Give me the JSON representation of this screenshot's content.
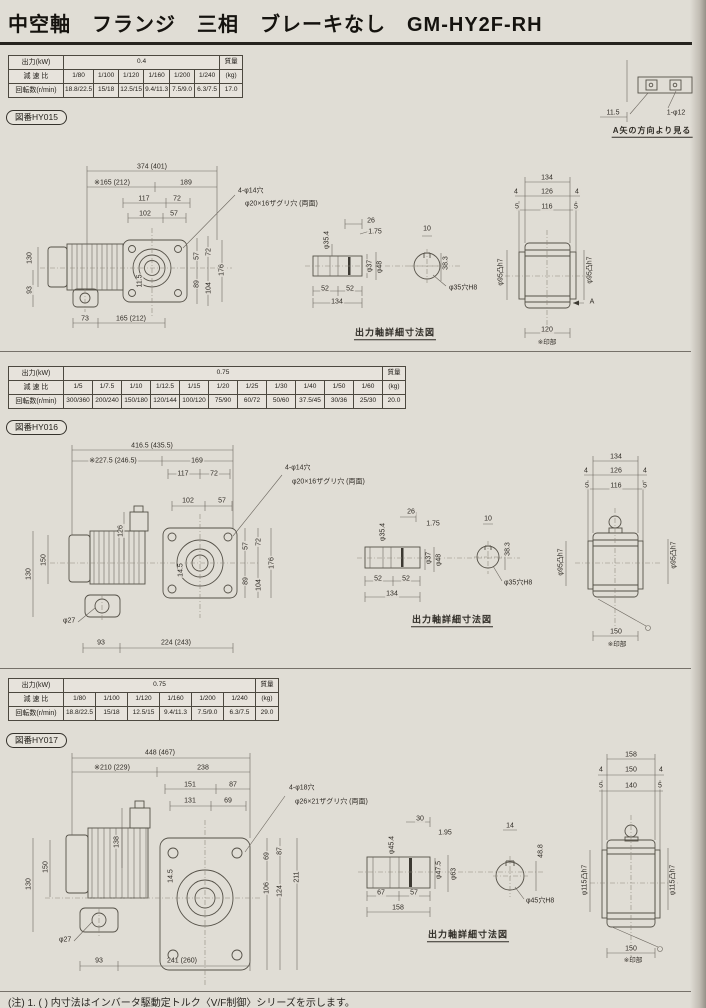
{
  "page": {
    "title": "中空軸　フランジ　三相　ブレーキなし　GM-HY2F-RH",
    "footnote": "(注) 1. ( ) 内寸法はインバータ駆動定トルク〈V/F制御〉シリーズを示します。"
  },
  "viewA": {
    "labels": [
      {
        "t": "11.5",
        "x": 613,
        "y": 113
      },
      {
        "t": "1-φ12",
        "x": 676,
        "y": 113
      },
      {
        "t": "A矢の方向より見る",
        "x": 652,
        "y": 132,
        "u": 1,
        "fs": 8
      }
    ]
  },
  "sections": [
    {
      "badge": "図番HY015",
      "table": {
        "rows": [
          {
            "head": "出力(kW)",
            "merged": "0.4",
            "span": 6,
            "tail": "質量"
          },
          {
            "head": "減 速 比",
            "cells": [
              "1/80",
              "1/100",
              "1/120",
              "1/160",
              "1/200",
              "1/240"
            ],
            "tail": "(kg)"
          },
          {
            "head": "回転数(r/min)",
            "cells": [
              "18.8/22.5",
              "15/18",
              "12.5/15",
              "9.4/11.3",
              "7.5/9.0",
              "6.3/7.5"
            ],
            "tail": "17.0"
          }
        ]
      },
      "labels": [
        {
          "t": "374 (401)",
          "x": 152,
          "y": 167
        },
        {
          "t": "※165 (212)",
          "x": 112,
          "y": 183
        },
        {
          "t": "189",
          "x": 186,
          "y": 183
        },
        {
          "t": "117",
          "x": 144,
          "y": 199
        },
        {
          "t": "72",
          "x": 177,
          "y": 199
        },
        {
          "t": "102",
          "x": 145,
          "y": 214
        },
        {
          "t": "57",
          "x": 174,
          "y": 214
        },
        {
          "t": "4-φ14穴",
          "x": 237,
          "y": 191,
          "a": "l"
        },
        {
          "t": "φ20×16ザグリ穴 (両面)",
          "x": 244,
          "y": 204,
          "a": "l"
        },
        {
          "t": "130",
          "x": 30,
          "y": 258,
          "r": -90
        },
        {
          "t": "93",
          "x": 30,
          "y": 290,
          "r": -90
        },
        {
          "t": "11.5",
          "x": 140,
          "y": 281,
          "r": -90
        },
        {
          "t": "57",
          "x": 197,
          "y": 256,
          "r": -90
        },
        {
          "t": "72",
          "x": 209,
          "y": 252,
          "r": -90
        },
        {
          "t": "89",
          "x": 197,
          "y": 284,
          "r": -90
        },
        {
          "t": "104",
          "x": 209,
          "y": 288,
          "r": -90
        },
        {
          "t": "176",
          "x": 222,
          "y": 270,
          "r": -90
        },
        {
          "t": "73",
          "x": 85,
          "y": 319
        },
        {
          "t": "165 (212)",
          "x": 131,
          "y": 319
        },
        {
          "t": "26",
          "x": 371,
          "y": 221
        },
        {
          "t": "1.75",
          "x": 375,
          "y": 232
        },
        {
          "t": "φ35.4",
          "x": 327,
          "y": 240,
          "r": -90
        },
        {
          "t": "φ37",
          "x": 370,
          "y": 266,
          "r": -90
        },
        {
          "t": "φ48",
          "x": 380,
          "y": 267,
          "r": -90
        },
        {
          "t": "52",
          "x": 325,
          "y": 289
        },
        {
          "t": "52",
          "x": 350,
          "y": 289
        },
        {
          "t": "134",
          "x": 337,
          "y": 302
        },
        {
          "t": "10",
          "x": 427,
          "y": 229
        },
        {
          "t": "38.3",
          "x": 446,
          "y": 263,
          "r": -90
        },
        {
          "t": "φ35穴H8",
          "x": 448,
          "y": 288,
          "a": "l"
        },
        {
          "t": "出力軸詳細寸法図",
          "x": 395,
          "y": 334,
          "u": 1,
          "fs": 9
        },
        {
          "t": "134",
          "x": 547,
          "y": 178
        },
        {
          "t": "4",
          "x": 516,
          "y": 192
        },
        {
          "t": "126",
          "x": 547,
          "y": 192
        },
        {
          "t": "4",
          "x": 577,
          "y": 192
        },
        {
          "t": "5",
          "x": 517,
          "y": 207
        },
        {
          "t": "116",
          "x": 547,
          "y": 207
        },
        {
          "t": "5",
          "x": 576,
          "y": 207
        },
        {
          "t": "φ95凸h7",
          "x": 501,
          "y": 272,
          "r": -90
        },
        {
          "t": "φ95凸h7",
          "x": 590,
          "y": 270,
          "r": -90
        },
        {
          "t": "A",
          "x": 592,
          "y": 302
        },
        {
          "t": "120",
          "x": 547,
          "y": 330
        },
        {
          "t": "※印部",
          "x": 547,
          "y": 343,
          "fs": 6.5
        }
      ]
    },
    {
      "badge": "図番HY016",
      "table": {
        "rows": [
          {
            "head": "出力(kW)",
            "merged": "0.75",
            "span": 11,
            "tail": "質量"
          },
          {
            "head": "減 速 比",
            "cells": [
              "1/5",
              "1/7.5",
              "1/10",
              "1/12.5",
              "1/15",
              "1/20",
              "1/25",
              "1/30",
              "1/40",
              "1/50",
              "1/60"
            ],
            "tail": "(kg)"
          },
          {
            "head": "回転数(r/min)",
            "cells": [
              "300/360",
              "200/240",
              "150/180",
              "120/144",
              "100/120",
              "75/90",
              "60/72",
              "50/60",
              "37.5/45",
              "30/36",
              "25/30"
            ],
            "tail": "20.0"
          }
        ]
      },
      "labels": [
        {
          "t": "416.5 (435.5)",
          "x": 152,
          "y": 446
        },
        {
          "t": "※227.5 (246.5)",
          "x": 113,
          "y": 461
        },
        {
          "t": "169",
          "x": 197,
          "y": 461
        },
        {
          "t": "117",
          "x": 183,
          "y": 474
        },
        {
          "t": "72",
          "x": 214,
          "y": 474
        },
        {
          "t": "102",
          "x": 188,
          "y": 501
        },
        {
          "t": "57",
          "x": 222,
          "y": 501
        },
        {
          "t": "4-φ14穴",
          "x": 284,
          "y": 468,
          "a": "l"
        },
        {
          "t": "φ20×16ザグリ穴 (両面)",
          "x": 291,
          "y": 482,
          "a": "l"
        },
        {
          "t": "126",
          "x": 121,
          "y": 531,
          "r": -90
        },
        {
          "t": "150",
          "x": 44,
          "y": 560,
          "r": -90
        },
        {
          "t": "130",
          "x": 29,
          "y": 574,
          "r": -90
        },
        {
          "t": "14.5",
          "x": 181,
          "y": 570,
          "r": -90
        },
        {
          "t": "57",
          "x": 246,
          "y": 546,
          "r": -90
        },
        {
          "t": "72",
          "x": 259,
          "y": 542,
          "r": -90
        },
        {
          "t": "89",
          "x": 246,
          "y": 581,
          "r": -90
        },
        {
          "t": "104",
          "x": 259,
          "y": 585,
          "r": -90
        },
        {
          "t": "176",
          "x": 272,
          "y": 563,
          "r": -90
        },
        {
          "t": "φ27",
          "x": 62,
          "y": 621,
          "a": "l"
        },
        {
          "t": "93",
          "x": 101,
          "y": 643
        },
        {
          "t": "224 (243)",
          "x": 176,
          "y": 643
        },
        {
          "t": "26",
          "x": 411,
          "y": 512
        },
        {
          "t": "1.75",
          "x": 433,
          "y": 524
        },
        {
          "t": "φ35.4",
          "x": 383,
          "y": 532,
          "r": -90
        },
        {
          "t": "φ37",
          "x": 429,
          "y": 558,
          "r": -90
        },
        {
          "t": "φ48",
          "x": 439,
          "y": 560,
          "r": -90
        },
        {
          "t": "52",
          "x": 378,
          "y": 579
        },
        {
          "t": "52",
          "x": 406,
          "y": 579
        },
        {
          "t": "134",
          "x": 392,
          "y": 594
        },
        {
          "t": "10",
          "x": 488,
          "y": 519
        },
        {
          "t": "38.3",
          "x": 508,
          "y": 549,
          "r": -90
        },
        {
          "t": "φ35穴H8",
          "x": 503,
          "y": 583,
          "a": "l"
        },
        {
          "t": "出力軸詳細寸法図",
          "x": 452,
          "y": 621,
          "u": 1,
          "fs": 9
        },
        {
          "t": "134",
          "x": 616,
          "y": 457
        },
        {
          "t": "4",
          "x": 586,
          "y": 471
        },
        {
          "t": "126",
          "x": 616,
          "y": 471
        },
        {
          "t": "4",
          "x": 645,
          "y": 471
        },
        {
          "t": "5",
          "x": 587,
          "y": 486
        },
        {
          "t": "116",
          "x": 616,
          "y": 486
        },
        {
          "t": "5",
          "x": 645,
          "y": 486
        },
        {
          "t": "φ95凸h7",
          "x": 561,
          "y": 562,
          "r": -90
        },
        {
          "t": "φ95凸h7",
          "x": 674,
          "y": 555,
          "r": -90
        },
        {
          "t": "150",
          "x": 616,
          "y": 632
        },
        {
          "t": "※印部",
          "x": 617,
          "y": 645,
          "fs": 6.5
        }
      ]
    },
    {
      "badge": "図番HY017",
      "table": {
        "rows": [
          {
            "head": "出力(kW)",
            "merged": "0.75",
            "span": 6,
            "tail": "質量"
          },
          {
            "head": "減 速 比",
            "cells": [
              "1/80",
              "1/100",
              "1/120",
              "1/160",
              "1/200",
              "1/240"
            ],
            "tail": "(kg)"
          },
          {
            "head": "回転数(r/min)",
            "cells": [
              "18.8/22.5",
              "15/18",
              "12.5/15",
              "9.4/11.3",
              "7.5/9.0",
              "6.3/7.5"
            ],
            "tail": "29.0"
          }
        ]
      },
      "labels": [
        {
          "t": "448 (467)",
          "x": 160,
          "y": 753
        },
        {
          "t": "※210 (229)",
          "x": 112,
          "y": 768
        },
        {
          "t": "238",
          "x": 203,
          "y": 768
        },
        {
          "t": "151",
          "x": 190,
          "y": 785
        },
        {
          "t": "87",
          "x": 233,
          "y": 785
        },
        {
          "t": "131",
          "x": 190,
          "y": 801
        },
        {
          "t": "69",
          "x": 228,
          "y": 801
        },
        {
          "t": "4-φ18穴",
          "x": 288,
          "y": 788,
          "a": "l"
        },
        {
          "t": "φ26×21ザグリ穴 (両面)",
          "x": 294,
          "y": 802,
          "a": "l"
        },
        {
          "t": "138",
          "x": 117,
          "y": 842,
          "r": -90
        },
        {
          "t": "150",
          "x": 46,
          "y": 867,
          "r": -90
        },
        {
          "t": "130",
          "x": 29,
          "y": 884,
          "r": -90
        },
        {
          "t": "14.5",
          "x": 171,
          "y": 876,
          "r": -90
        },
        {
          "t": "69",
          "x": 267,
          "y": 856,
          "r": -90
        },
        {
          "t": "87",
          "x": 280,
          "y": 851,
          "r": -90
        },
        {
          "t": "106",
          "x": 267,
          "y": 888,
          "r": -90
        },
        {
          "t": "124",
          "x": 280,
          "y": 891,
          "r": -90
        },
        {
          "t": "211",
          "x": 297,
          "y": 877,
          "r": -90
        },
        {
          "t": "φ27",
          "x": 58,
          "y": 940,
          "a": "l"
        },
        {
          "t": "93",
          "x": 99,
          "y": 961
        },
        {
          "t": "241 (260)",
          "x": 182,
          "y": 961
        },
        {
          "t": "30",
          "x": 420,
          "y": 819
        },
        {
          "t": "1.95",
          "x": 445,
          "y": 833
        },
        {
          "t": "φ45.4",
          "x": 392,
          "y": 845,
          "r": -90
        },
        {
          "t": "φ47.5",
          "x": 439,
          "y": 870,
          "r": -90
        },
        {
          "t": "φ63",
          "x": 454,
          "y": 874,
          "r": -90
        },
        {
          "t": "67",
          "x": 381,
          "y": 893
        },
        {
          "t": "57",
          "x": 414,
          "y": 893
        },
        {
          "t": "158",
          "x": 398,
          "y": 908
        },
        {
          "t": "14",
          "x": 510,
          "y": 826
        },
        {
          "t": "48.8",
          "x": 541,
          "y": 851,
          "r": -90
        },
        {
          "t": "φ45穴H8",
          "x": 525,
          "y": 901,
          "a": "l"
        },
        {
          "t": "出力軸詳細寸法図",
          "x": 468,
          "y": 936,
          "u": 1,
          "fs": 9
        },
        {
          "t": "158",
          "x": 631,
          "y": 755
        },
        {
          "t": "4",
          "x": 601,
          "y": 770
        },
        {
          "t": "150",
          "x": 631,
          "y": 770
        },
        {
          "t": "4",
          "x": 661,
          "y": 770
        },
        {
          "t": "5",
          "x": 601,
          "y": 786
        },
        {
          "t": "140",
          "x": 631,
          "y": 786
        },
        {
          "t": "5",
          "x": 660,
          "y": 786
        },
        {
          "t": "φ115凸h7",
          "x": 585,
          "y": 880,
          "r": -90
        },
        {
          "t": "φ115凸h7",
          "x": 673,
          "y": 880,
          "r": -90
        },
        {
          "t": "150",
          "x": 631,
          "y": 949
        },
        {
          "t": "※印部",
          "x": 633,
          "y": 961,
          "fs": 6.5
        }
      ]
    }
  ]
}
